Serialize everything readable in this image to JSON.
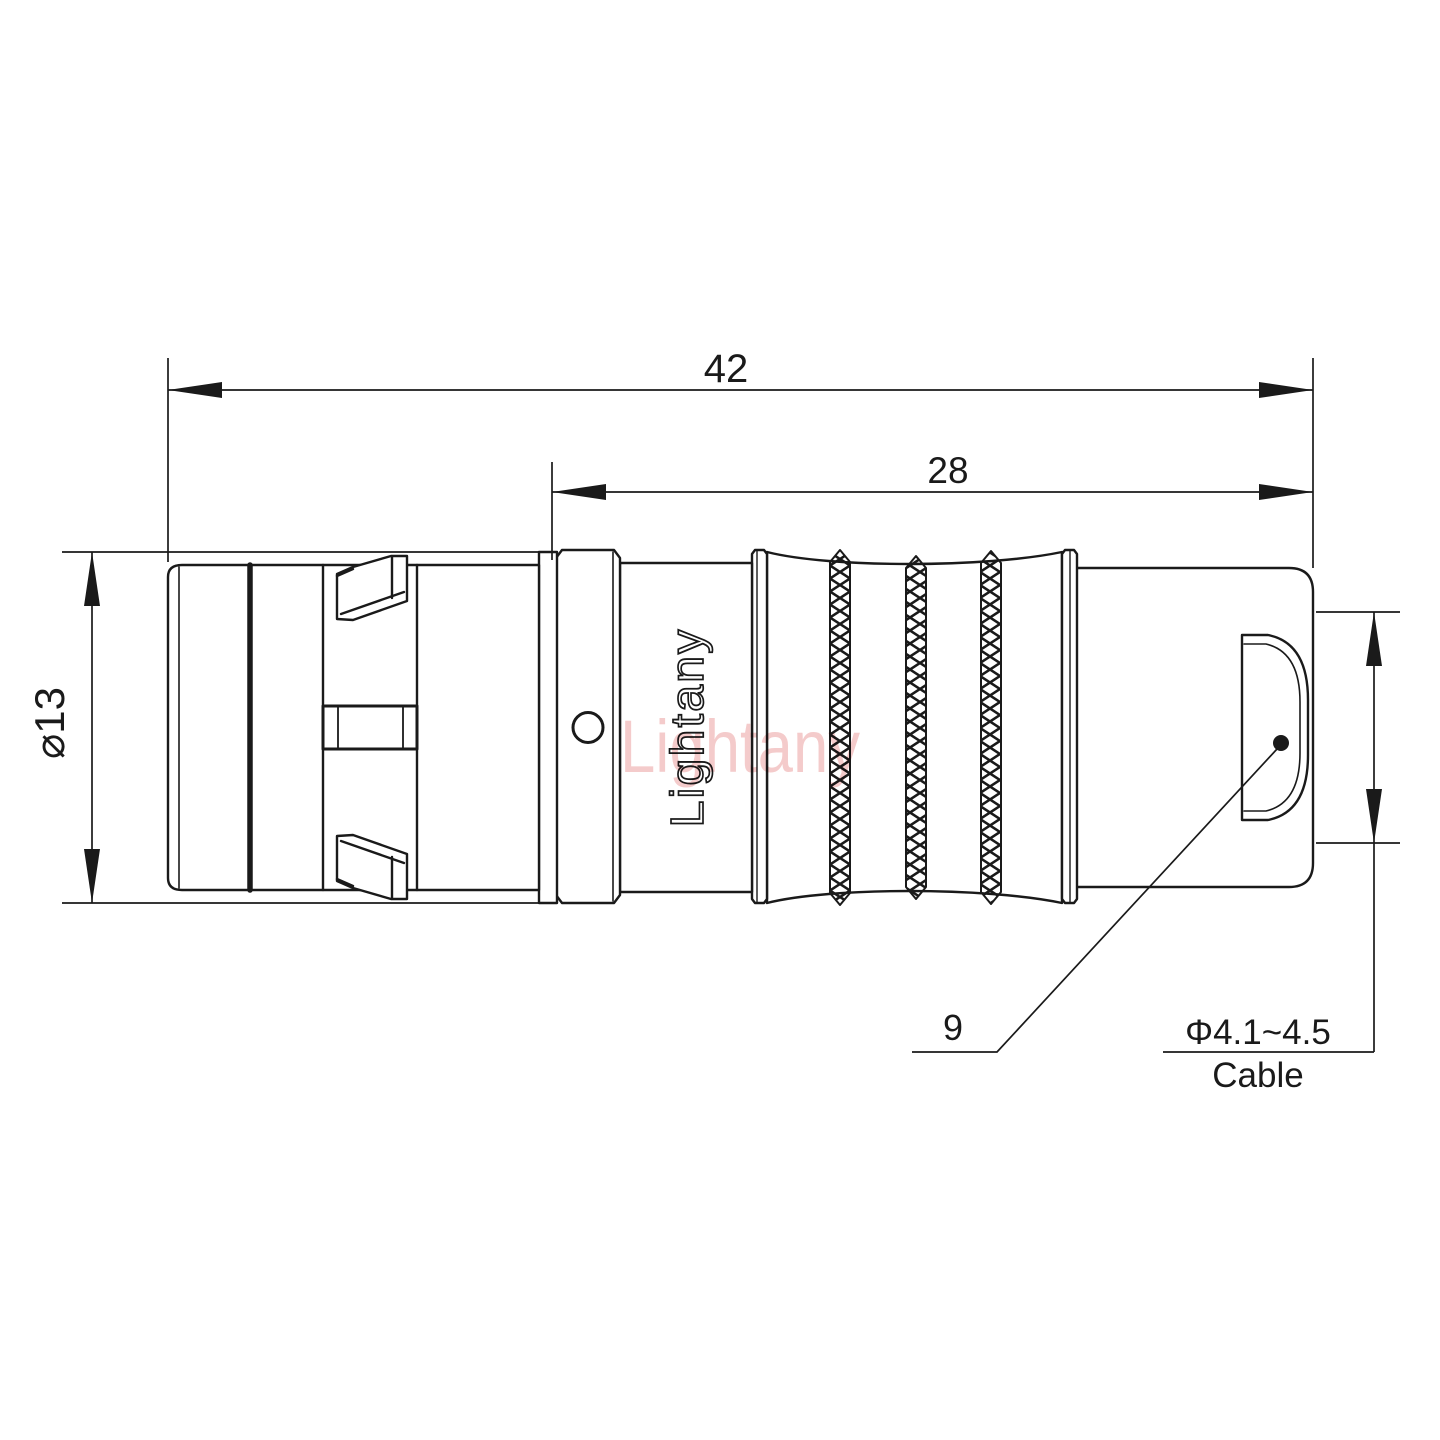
{
  "page": {
    "background": "#ffffff",
    "description": "Technical dimension drawing of a push-pull circular connector plug, side view"
  },
  "drawing": {
    "line_color": "#1a1a1a",
    "watermark_color": "#f3c2c2",
    "labels": {
      "overall_length": "42",
      "rear_length": "28",
      "body_diameter": "⌀13",
      "shell_size": "9",
      "cable_range": "Φ4.1~4.5",
      "cable_word": "Cable"
    },
    "branding": {
      "body_marking": "Lightany",
      "watermark": "Lightany"
    }
  }
}
